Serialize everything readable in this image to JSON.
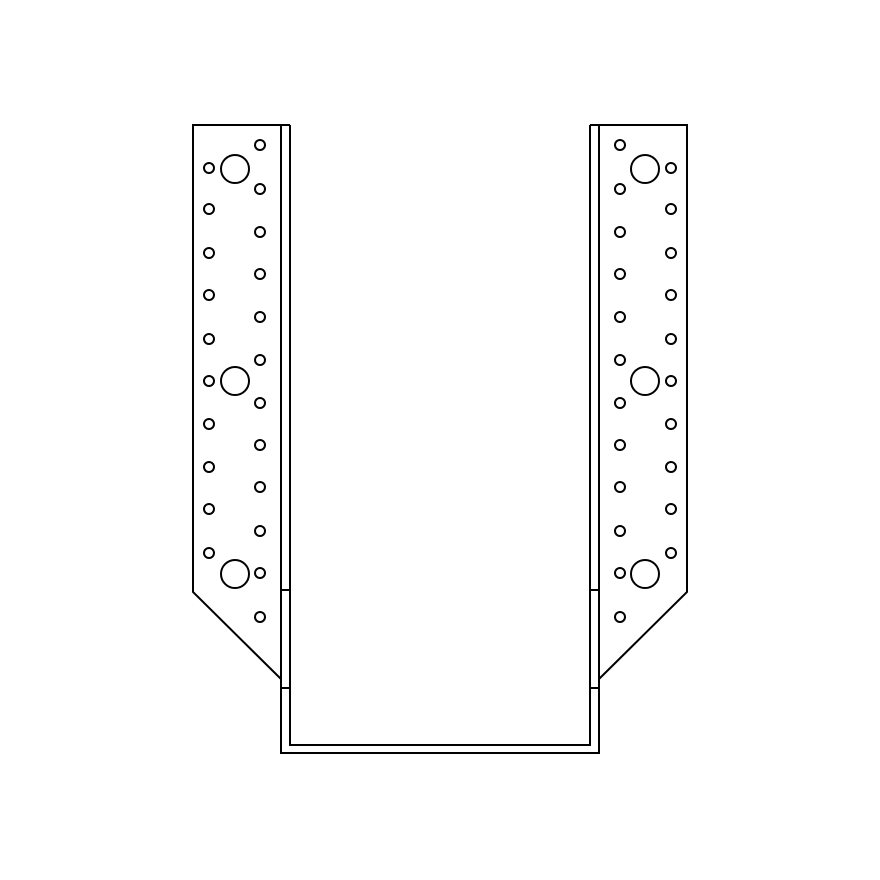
{
  "page": {
    "width": 880,
    "height": 880,
    "background": "#ffffff"
  },
  "drawing": {
    "subject": "joist-hanger-front-elevation-line-drawing",
    "stroke_color": "#000000",
    "stroke_width": 2,
    "fill_color": "none",
    "stirrup": {
      "outer": {
        "left": 281,
        "right": 599,
        "top": 125,
        "bottom": 753
      },
      "inner": {
        "left": 290,
        "right": 590,
        "top": 125,
        "bottom": 745
      }
    },
    "flanges": [
      {
        "side": "left",
        "outline": {
          "cap_inner_x": 290,
          "outer_x": 193,
          "top_y": 125,
          "edge_bottom_y": 592,
          "chamfer_x": 281,
          "chamfer_y": 679
        },
        "fold_ticks": {
          "x1": 281,
          "x2": 290,
          "ys": [
            590,
            688
          ]
        },
        "hole_columns": [
          {
            "name": "inner-nail-hole",
            "x": 260,
            "r": 5,
            "rows": [
              145,
              189,
              232,
              274,
              317,
              360,
              403,
              445,
              487,
              531,
              573,
              617
            ]
          },
          {
            "name": "outer-nail-hole",
            "x": 209,
            "r": 5,
            "rows": [
              168,
              209,
              253,
              295,
              339,
              381,
              424,
              467,
              509,
              553
            ]
          },
          {
            "name": "large-bolt-hole",
            "x": 235,
            "r": 14,
            "rows": [
              169,
              381,
              574
            ]
          }
        ]
      },
      {
        "side": "right",
        "outline": {
          "cap_inner_x": 590,
          "outer_x": 687,
          "top_y": 125,
          "edge_bottom_y": 592,
          "chamfer_x": 599,
          "chamfer_y": 679
        },
        "fold_ticks": {
          "x1": 590,
          "x2": 599,
          "ys": [
            590,
            688
          ]
        },
        "hole_columns": [
          {
            "name": "inner-nail-hole",
            "x": 620,
            "r": 5,
            "rows": [
              145,
              189,
              232,
              274,
              317,
              360,
              403,
              445,
              487,
              531,
              573,
              617
            ]
          },
          {
            "name": "outer-nail-hole",
            "x": 671,
            "r": 5,
            "rows": [
              168,
              209,
              253,
              295,
              339,
              381,
              424,
              467,
              509,
              553
            ]
          },
          {
            "name": "large-bolt-hole",
            "x": 645,
            "r": 14,
            "rows": [
              169,
              381,
              574
            ]
          }
        ]
      }
    ]
  }
}
